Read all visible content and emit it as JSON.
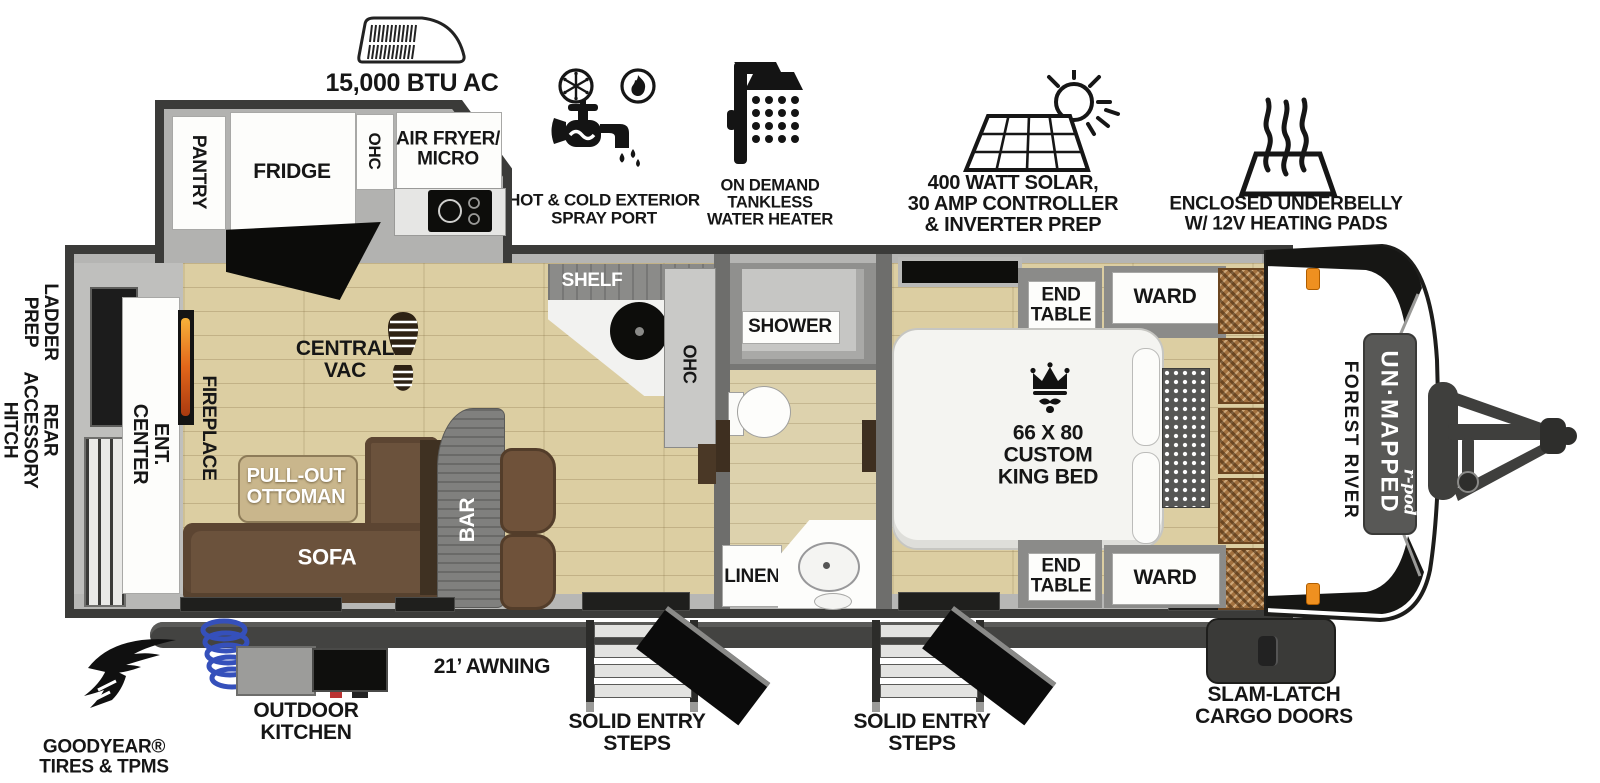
{
  "palette": {
    "outline": "#3b3b39",
    "wall_gray": "#a2a2a0",
    "wall_light": "#b7b7b5",
    "floor_wood": "#dccea2",
    "sofa_brown": "#6b523c",
    "ottoman_tan": "#c9b68c",
    "bar_gray": "#80807e",
    "basket_brown": "#a2713f",
    "accent_orange": "#ef9020",
    "flame_orange": "#e2661a",
    "hose_blue": "#3550bb",
    "icon_black": "#161616"
  },
  "features": {
    "ac": {
      "label": "15,000 BTU AC"
    },
    "spray_port": {
      "label": "HOT & COLD EXTERIOR\nSPRAY PORT"
    },
    "water_heater": {
      "label": "ON DEMAND\nTANKLESS\nWATER HEATER"
    },
    "solar": {
      "label": "400 WATT SOLAR,\n30 AMP CONTROLLER\n& INVERTER PREP"
    },
    "underbelly": {
      "label": "ENCLOSED UNDERBELLY\nW/ 12V HEATING PADS"
    }
  },
  "exterior": {
    "ladder_prep": "LADDER\nPREP",
    "rear_accessory_hitch": "REAR\nACCESSORY\nHITCH",
    "goodyear": "GOODYEAR®\nTIRES & TPMS",
    "outdoor_kitchen": "OUTDOOR\nKITCHEN",
    "awning": "21’ AWNING",
    "entry_steps_mid": "SOLID ENTRY\nSTEPS",
    "entry_steps_front": "SOLID ENTRY\nSTEPS",
    "cargo_doors": "SLAM-LATCH\nCARGO DOORS"
  },
  "kitchen": {
    "pantry": "PANTRY",
    "fridge": "FRIDGE",
    "ohc": "OHC",
    "air_fryer_micro": "AIR FRYER/\nMICRO"
  },
  "living": {
    "ent_center": "ENT.\nCENTER",
    "fireplace": "FIREPLACE",
    "central_vac": "CENTRAL\nVAC",
    "shelf": "SHELF",
    "ohc": "OHC",
    "pull_out_ottoman": "PULL-OUT\nOTTOMAN",
    "sofa": "SOFA",
    "bar": "BAR"
  },
  "bath": {
    "shower": "SHOWER",
    "linen": "LINEN"
  },
  "bedroom": {
    "end_table_top": "END\nTABLE",
    "ward_top": "WARD",
    "bed": "66 X 80\nCUSTOM\nKING BED",
    "end_table_bottom": "END\nTABLE",
    "ward_bottom": "WARD"
  },
  "branding": {
    "make": "FOREST RIVER",
    "model": "UN·MAPPED",
    "submodel": "r-pod"
  }
}
